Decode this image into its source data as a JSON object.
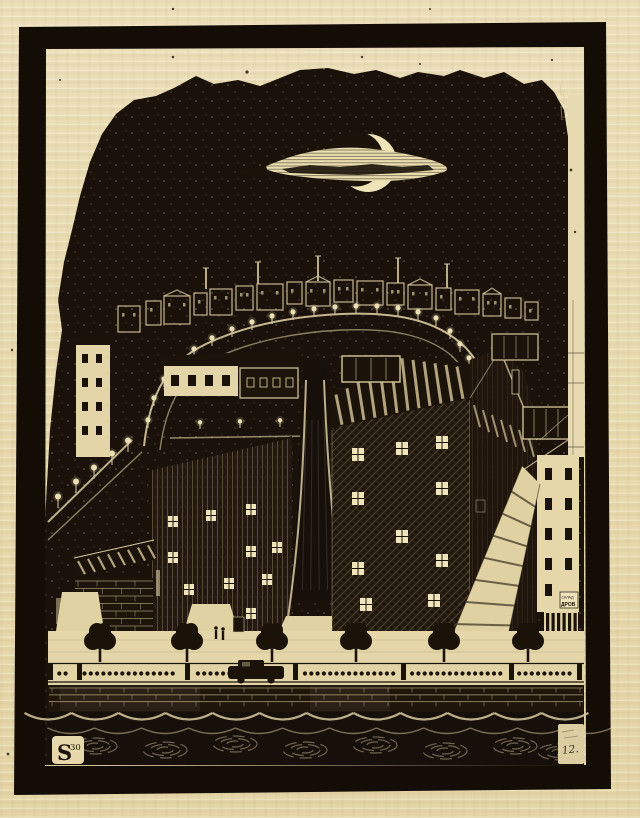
{
  "artwork": {
    "medium_hint": "black-ink woodcut print of a night city embankment with crescent moon",
    "ink_color": "#1b130a",
    "paper_color": "#e9dcb4",
    "signature_monogram": "S",
    "signature_year": "30",
    "plate_number": "12.",
    "building_sign_line1": "СКЛАД",
    "building_sign_line2": "ДРОВ"
  }
}
